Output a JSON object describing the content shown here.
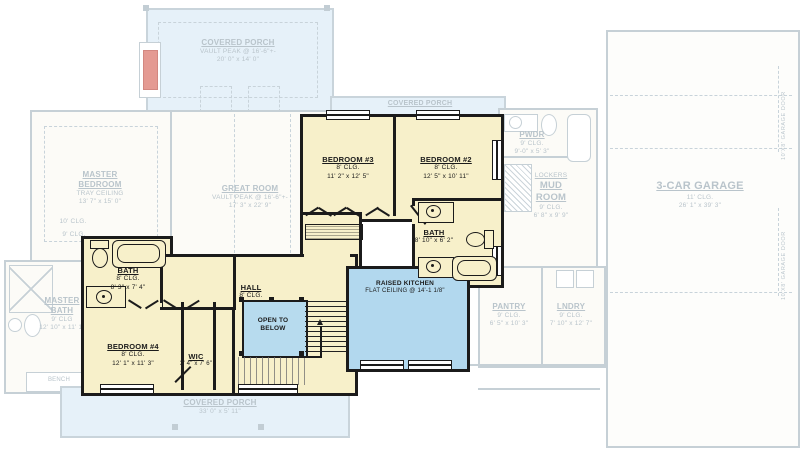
{
  "plan": {
    "porch_top": {
      "name": "COVERED PORCH",
      "ceiling": "VAULT PEAK @ 16'-6\"+-",
      "dims": "20' 0\" x 14' 0\""
    },
    "porch_mid": {
      "name": "COVERED PORCH"
    },
    "porch_bottom": {
      "name": "COVERED PORCH",
      "dims": "33' 0\" x 5' 11\""
    },
    "master_bedroom": {
      "name1": "MASTER",
      "name2": "BEDROOM",
      "ceiling": "TRAY CEILING",
      "dims": "13' 7\" x 15' 0\"",
      "note1": "10' CLG.",
      "note2": "9' CLG."
    },
    "great_room": {
      "name": "GREAT ROOM",
      "ceiling": "VAULT PEAK @ 16'-6\"+-",
      "dims": "17' 3\" x 22' 9\""
    },
    "bedroom2": {
      "name": "BEDROOM #2",
      "ceiling": "8' CLG.",
      "dims": "12' 5\" x 10' 11\""
    },
    "bedroom3": {
      "name": "BEDROOM #3",
      "ceiling": "8' CLG.",
      "dims": "11' 2\" x 12' 5\""
    },
    "bedroom4": {
      "name": "BEDROOM #4",
      "ceiling": "8' CLG.",
      "dims": "12' 1\" x 11' 3\""
    },
    "bath_right": {
      "name": "BATH",
      "dims": "8' 10\" x 6' 2\""
    },
    "bath_left": {
      "name": "BATH",
      "ceiling": "8' CLG.",
      "dims": "8' 3\" x 7' 4\""
    },
    "hall": {
      "name": "HALL",
      "ceiling": "8' CLG."
    },
    "open_below": {
      "line1": "OPEN TO",
      "line2": "BELOW"
    },
    "kitchen": {
      "name": "RAISED KITCHEN",
      "ceiling": "FLAT CEILING @ 14'-1 1/8\""
    },
    "wic": {
      "name": "WIC",
      "dims": "3' 4\" x 7' 6\""
    },
    "master_bath": {
      "name1": "MASTER",
      "name2": "BATH",
      "ceiling": "9' CLG",
      "dims": "12' 10\" x 11' 1\""
    },
    "pwdr": {
      "name": "PWDR",
      "ceiling": "9' CLG.",
      "dims": "9'-0\" x 5' 3\""
    },
    "mud_room": {
      "name1": "LOCKERS",
      "name2": "MUD",
      "name3": "ROOM",
      "ceiling": "9' CLG.",
      "dims": "6' 8\" x 9' 9\""
    },
    "pantry": {
      "name": "PANTRY",
      "ceiling": "9' CLG.",
      "dims": "6' 5\" x 10' 3\""
    },
    "laundry": {
      "name": "LNDRY",
      "ceiling": "9' CLG.",
      "dims": "7' 10\" x 12' 7\""
    },
    "garage": {
      "name": "3-CAR GARAGE",
      "ceiling": "11' CLG.",
      "dims": "26' 1\" x 39' 3\""
    },
    "bench": {
      "name": "BENCH"
    },
    "garage_door_label": "10'X8' GARAGE DOOR"
  },
  "colors": {
    "active_fill": "#f7f0ca",
    "active_wall": "#1b1b1b",
    "open_blue": "#b7dbee",
    "porch_blue": "#e6f1f9",
    "faded_line": "#c6d0d6",
    "faded_text": "#b9c4cb",
    "fireplace_red": "#e49a92"
  }
}
